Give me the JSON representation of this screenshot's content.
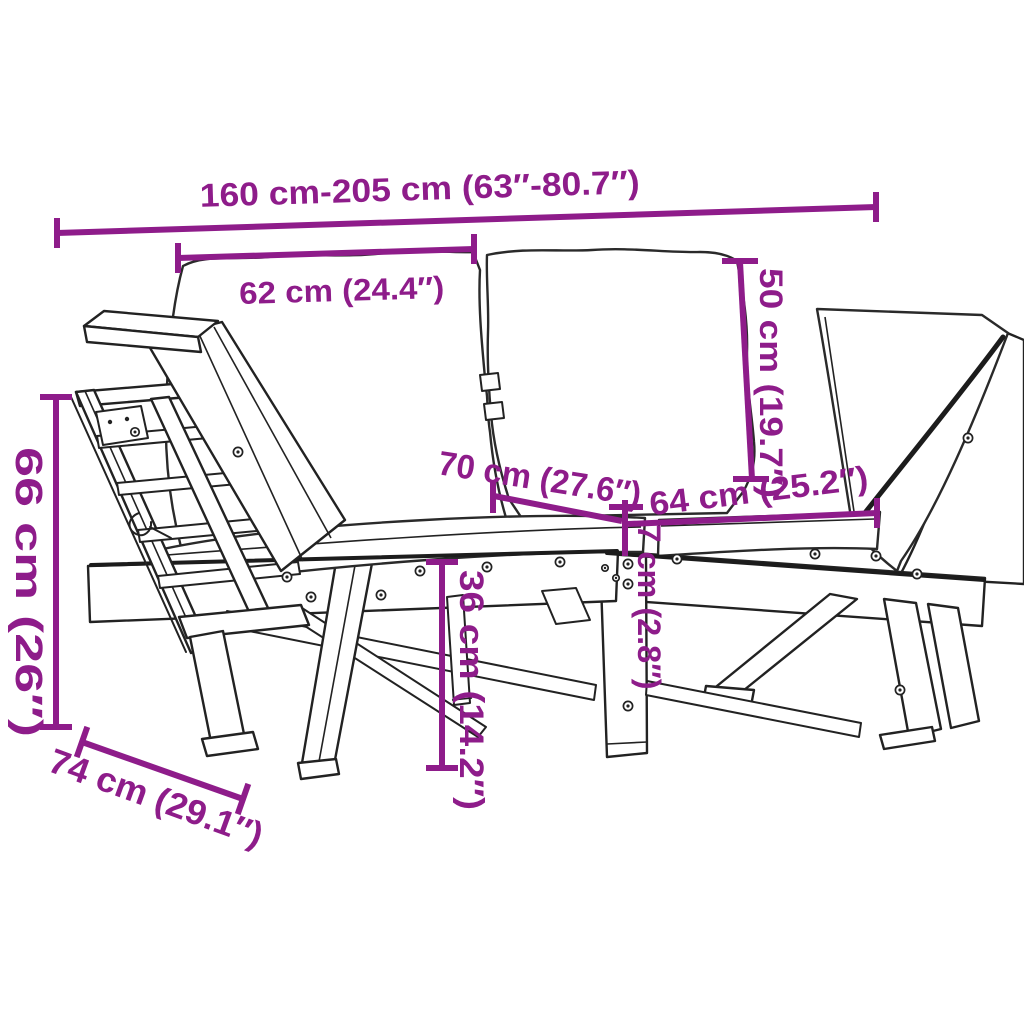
{
  "title": "2-in-1 garden bench with adjustable sides — dimension diagram",
  "colors": {
    "accent": "#8E1C8A",
    "line": "#222222",
    "background": "#FFFFFF"
  },
  "dimensions": {
    "total_length": "160 cm-205 cm (63″-80.7″)",
    "back_cushion_width": "62 cm (24.4″)",
    "backrest_height": "50 cm (19.7″)",
    "seat_depth": "70 cm (27.6″)",
    "seat_cushion_width": "64 cm (25.2″)",
    "cushion_thickness": "7 cm (2.8″)",
    "seat_height": "36 cm (14.2″)",
    "side_panel_height": "66 cm (26″)",
    "side_panel_depth": "74 cm (29.1″)"
  }
}
